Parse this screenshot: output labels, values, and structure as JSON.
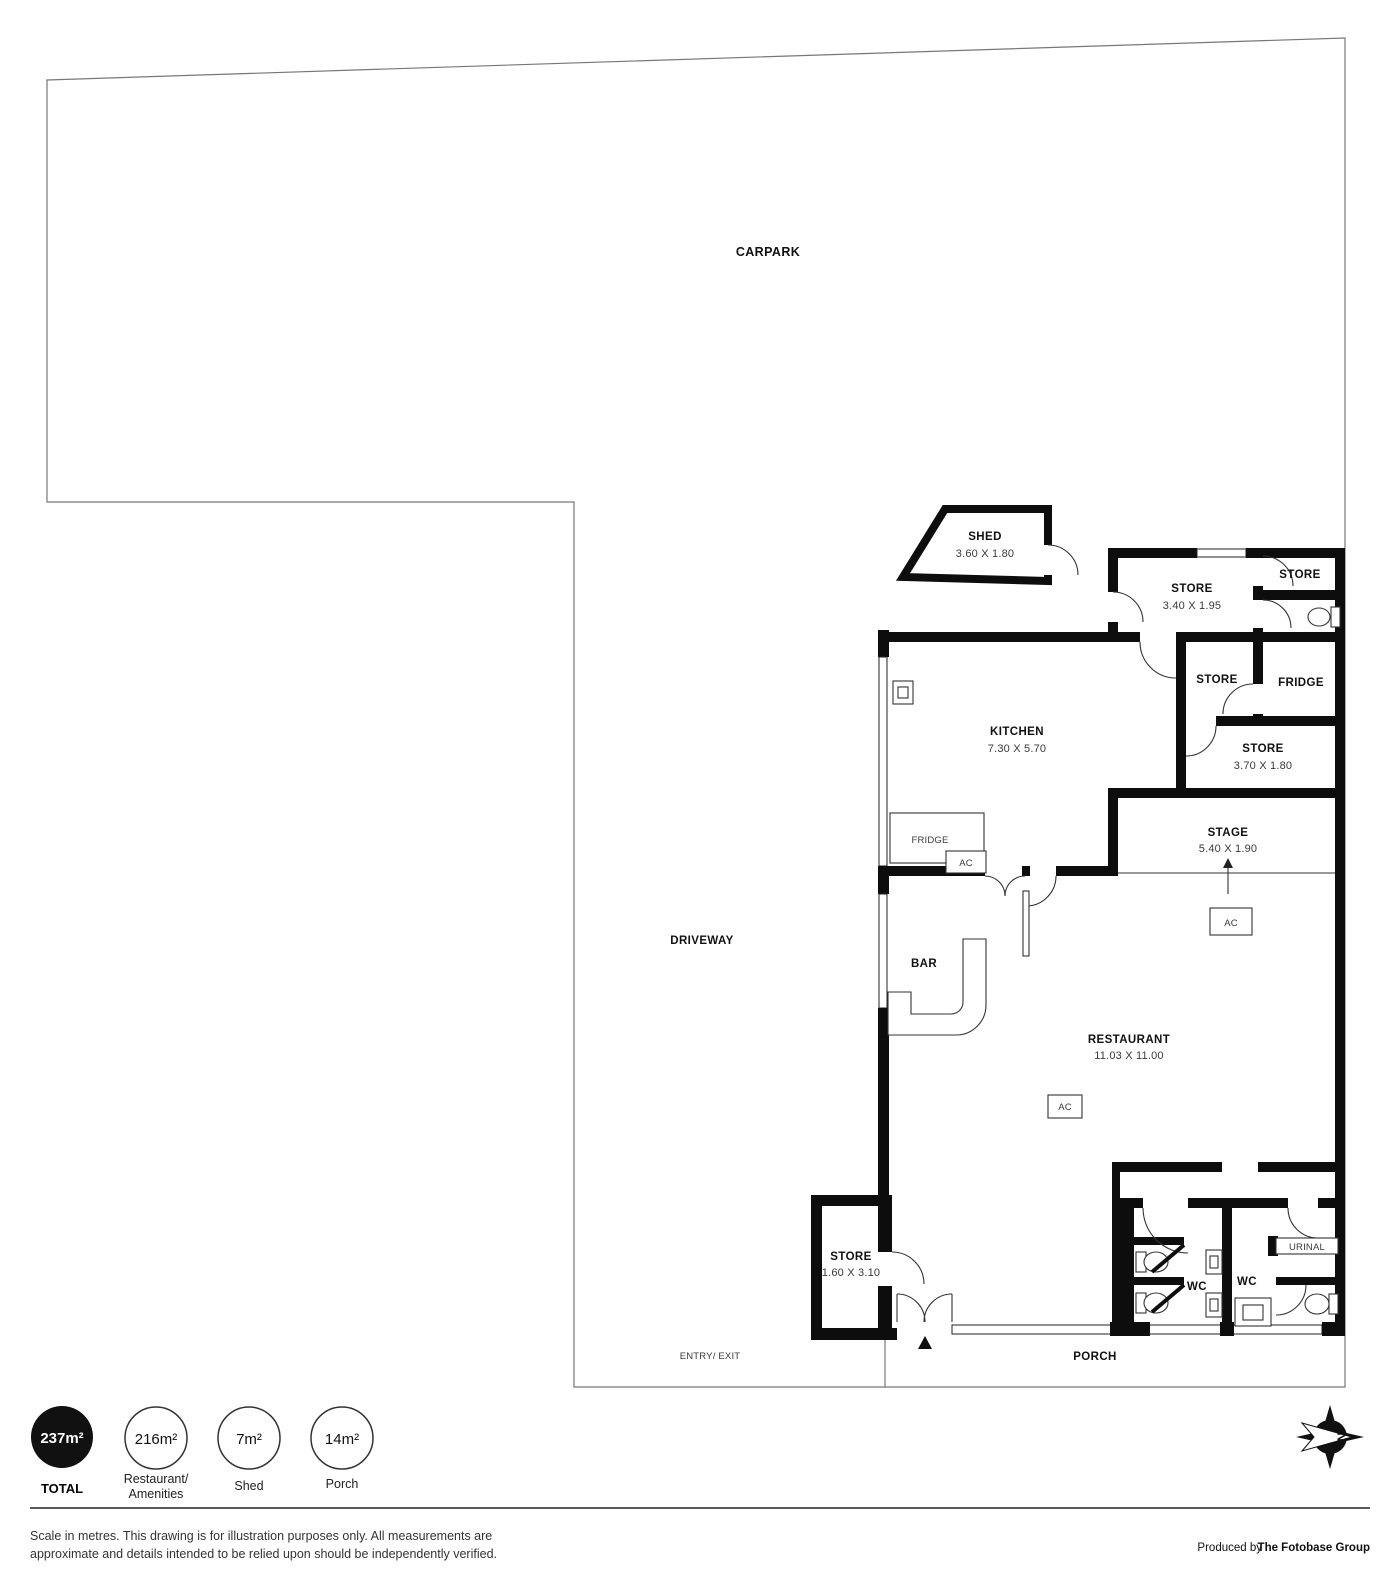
{
  "plan": {
    "carpark_label": "CARPARK",
    "driveway_label": "DRIVEWAY",
    "porch_label": "PORCH",
    "entry_exit_label": "ENTRY/ EXIT",
    "rooms": {
      "shed": {
        "name": "SHED",
        "dims": "3.60 X 1.80"
      },
      "store_top": {
        "name": "STORE",
        "dims": "3.40 X 1.95"
      },
      "store_top_right": {
        "name": "STORE"
      },
      "store_mid": {
        "name": "STORE"
      },
      "fridge_room": {
        "name": "FRIDGE"
      },
      "kitchen": {
        "name": "KITCHEN",
        "dims": "7.30 X 5.70"
      },
      "store_right": {
        "name": "STORE",
        "dims": "3.70 X 1.80"
      },
      "stage": {
        "name": "STAGE",
        "dims": "5.40 X 1.90"
      },
      "bar": {
        "name": "BAR"
      },
      "restaurant": {
        "name": "RESTAURANT",
        "dims": "11.03 X 11.00"
      },
      "store_bottom": {
        "name": "STORE",
        "dims": "1.60 X 3.10"
      },
      "wc_left": {
        "name": "WC"
      },
      "wc_right": {
        "name": "WC"
      }
    },
    "fixtures": {
      "fridge": "FRIDGE",
      "ac": "AC",
      "urinal": "URINAL"
    }
  },
  "legend": {
    "total": {
      "value": "237m²",
      "label": "TOTAL"
    },
    "restaurant": {
      "value": "216m²",
      "label_line1": "Restaurant/",
      "label_line2": "Amenities"
    },
    "shed": {
      "value": "7m²",
      "label": "Shed"
    },
    "porch": {
      "value": "14m²",
      "label": "Porch"
    }
  },
  "compass": {
    "letter": "N"
  },
  "footer": {
    "disclaimer_line1": "Scale in metres. This drawing is for illustration purposes only. All measurements are",
    "disclaimer_line2": "approximate and details intended to be relied upon should be independently verified.",
    "produced_by_prefix": "Produced by ",
    "produced_by_name": "The Fotobase Group"
  }
}
